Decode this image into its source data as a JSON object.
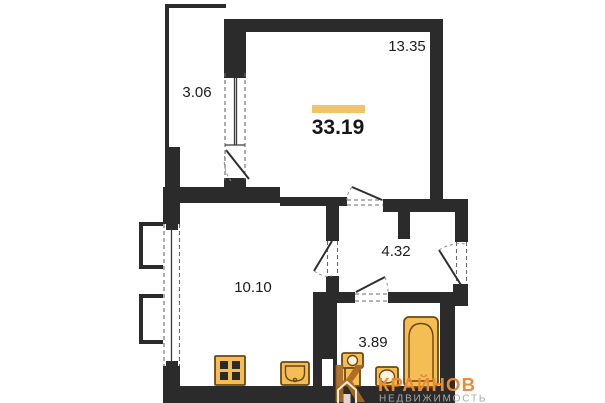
{
  "rooms": {
    "balcony": {
      "area": "3.06"
    },
    "living_room": {
      "area": "13.35"
    },
    "kitchen": {
      "area": "10.10"
    },
    "hallway": {
      "area": "4.32"
    },
    "bathroom": {
      "area": "3.89"
    }
  },
  "total": {
    "area": "33.19"
  },
  "watermark": {
    "monogram": "К",
    "name": "КРАЙНОВ",
    "subtitle": "НЕДВИЖИМОСТЬ"
  },
  "fixtures": [
    "stove",
    "kitchen-sink",
    "toilet",
    "washbasin",
    "bathtub"
  ],
  "colors": {
    "wall": "#2b2b2b",
    "accent": "#f2c469",
    "fixture": "#f4be55",
    "fixtureStroke": "#6b4714",
    "brand": "#ec8a33",
    "brandGray": "#a8a8a8"
  }
}
